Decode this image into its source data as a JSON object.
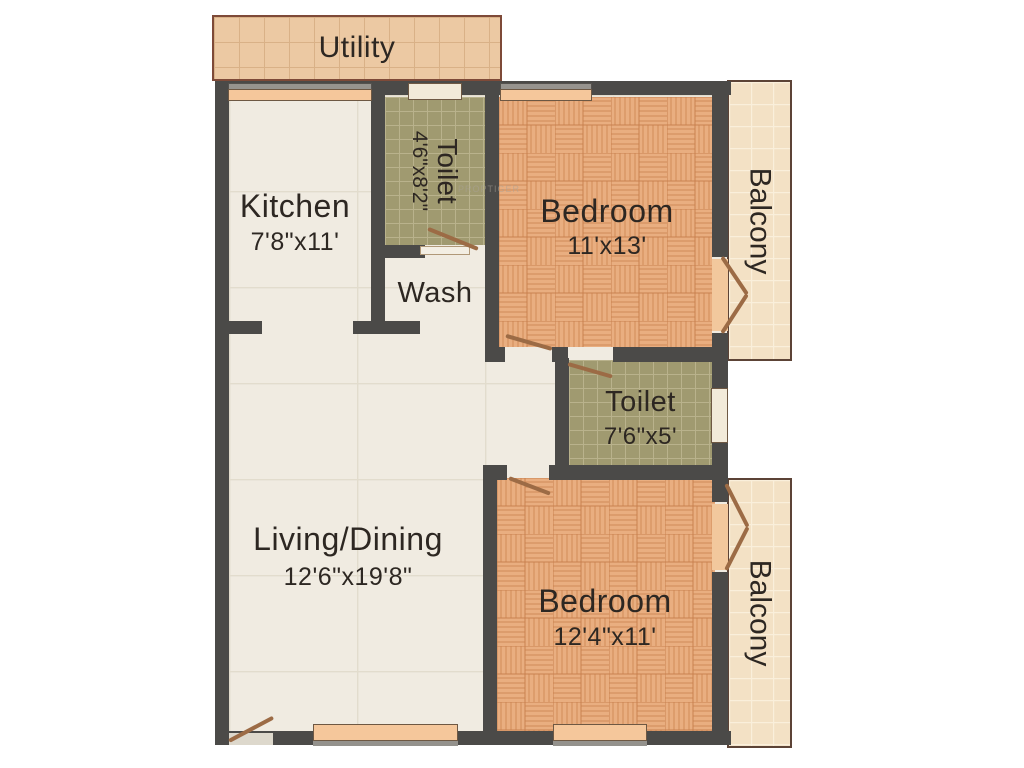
{
  "plan_title": "2BHK Floor Plan",
  "rooms": {
    "utility": {
      "label": "Utility"
    },
    "kitchen": {
      "label": "Kitchen",
      "dims": "7'8\"x11'"
    },
    "toilet1": {
      "label": "Toilet",
      "dims": "4'6\"x8'2\""
    },
    "wash": {
      "label": "Wash"
    },
    "bedroom1": {
      "label": "Bedroom",
      "dims": "11'x13'"
    },
    "balcony1": {
      "label": "Balcony"
    },
    "toilet2": {
      "label": "Toilet",
      "dims": "7'6\"x5'"
    },
    "living": {
      "label": "Living/Dining",
      "dims": "12'6\"x19'8\""
    },
    "bedroom2": {
      "label": "Bedroom",
      "dims": "12'4\"x11'"
    },
    "balcony2": {
      "label": "Balcony"
    }
  },
  "watermark": "PROPTIGER",
  "colors": {
    "wall": "#4b4a48",
    "door": "#9c6b45",
    "window_sill": "#f5c79b",
    "floor_cream": "#f0ebe1",
    "floor_parquet": "#e9ae80",
    "floor_toilet": "#a09a70",
    "floor_utility": "#ecc9a3",
    "floor_balcony": "#f3e1c5",
    "text": "#2d2722"
  }
}
